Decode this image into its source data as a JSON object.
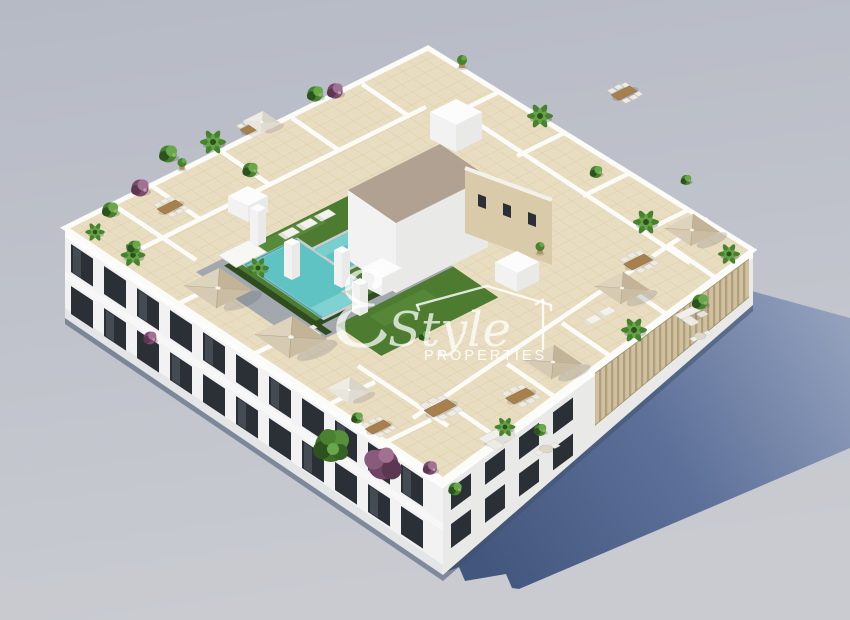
{
  "image": {
    "width": 850,
    "height": 620,
    "type": "3d-architectural-render",
    "description": "Aerial isometric 3D render of a white apartment building with a rooftop solarium: communal swimming pool with lawn, beige tiled private terraces divided by white walls, parasols, dining sets, sun loungers, palm trees and bougainvillea; long blue-grey shadow cast to the lower right on a plain grey ground; semi-transparent estate watermark in the centre."
  },
  "watermark": {
    "initial": "ℰ",
    "script": "Style",
    "caps": "PROPERTIES"
  },
  "colors": {
    "background_top": "#b6bac5",
    "background_bottom": "#c9cbd1",
    "shadow_near": "#42567e",
    "shadow_mid": "#5d7099",
    "shadow_far": "#93a1bd",
    "ao_dark": "#42536f",
    "wall_white": "#f1f2f1",
    "wall_bright": "#fbfcfb",
    "wall_shade": "#e9eae8",
    "parapet_white": "#fbfbf8",
    "window_dark": "#2b2f36",
    "window_glass": "#4a5159",
    "roof_tile": "#e9ddc1",
    "tile_line": "#dbcda9",
    "pool_water": "#5fc3c3",
    "pool_light": "#7fd2d1",
    "deck_gray": "#a2a8ad",
    "lawn_green": "#4d7c31",
    "lawn_light": "#5d9040",
    "hedge_dark": "#2f4b20",
    "plant_green": "#47822f",
    "plant_green_dark": "#2c5220",
    "plant_green_light": "#69a749",
    "plant_purple": "#7b4a6d",
    "plant_purple_dark": "#5c3752",
    "plant_purple_light": "#a17192",
    "umbrella_beige": "#d6cab2",
    "umbrella_beige_dark": "#c3b498",
    "umbrella_white": "#e9e6dd",
    "wood_table": "#a8804e",
    "chair_white": "#edebe4",
    "louvre_beige": "#cfc0a0",
    "louvre_dark": "#b19f7c",
    "core_roof_gray": "#b0a193",
    "core_wall_tan": "#d9caa9",
    "watermark_white": "#ffffff"
  }
}
